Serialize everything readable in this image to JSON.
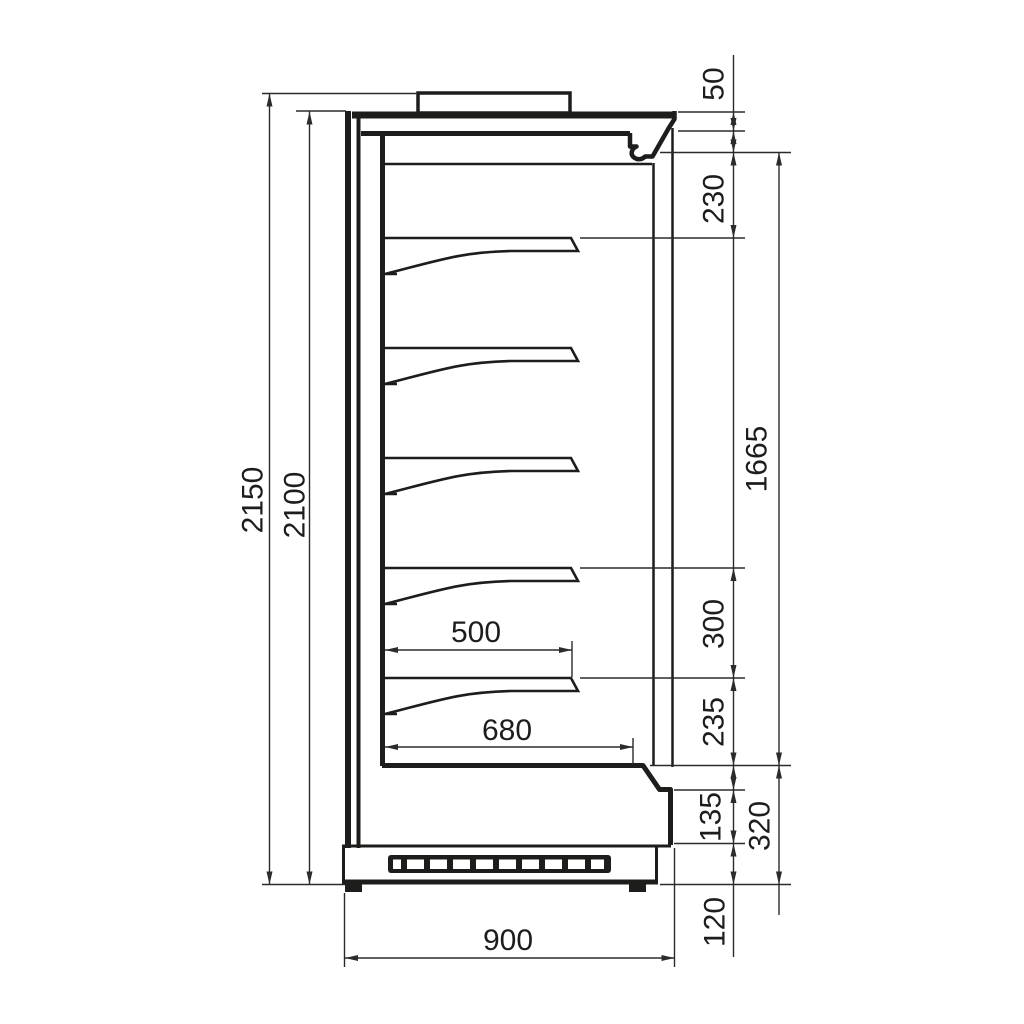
{
  "drawing": {
    "background_color": "#ffffff",
    "line_color": "#1d1d1b",
    "dimension_line_color": "#2b2b2b"
  },
  "dimensions": {
    "overall_height": "2150",
    "body_height": "2100",
    "canopy_thickness": "50",
    "top_clearance": "230",
    "display_opening_height": "1665",
    "shelf_spacing": "300",
    "bottom_shelf_to_deck": "235",
    "shelf_depth": "500",
    "deck_depth": "680",
    "front_panel_height": "135",
    "base_section_height": "320",
    "plinth_height": "120",
    "overall_depth": "900"
  }
}
